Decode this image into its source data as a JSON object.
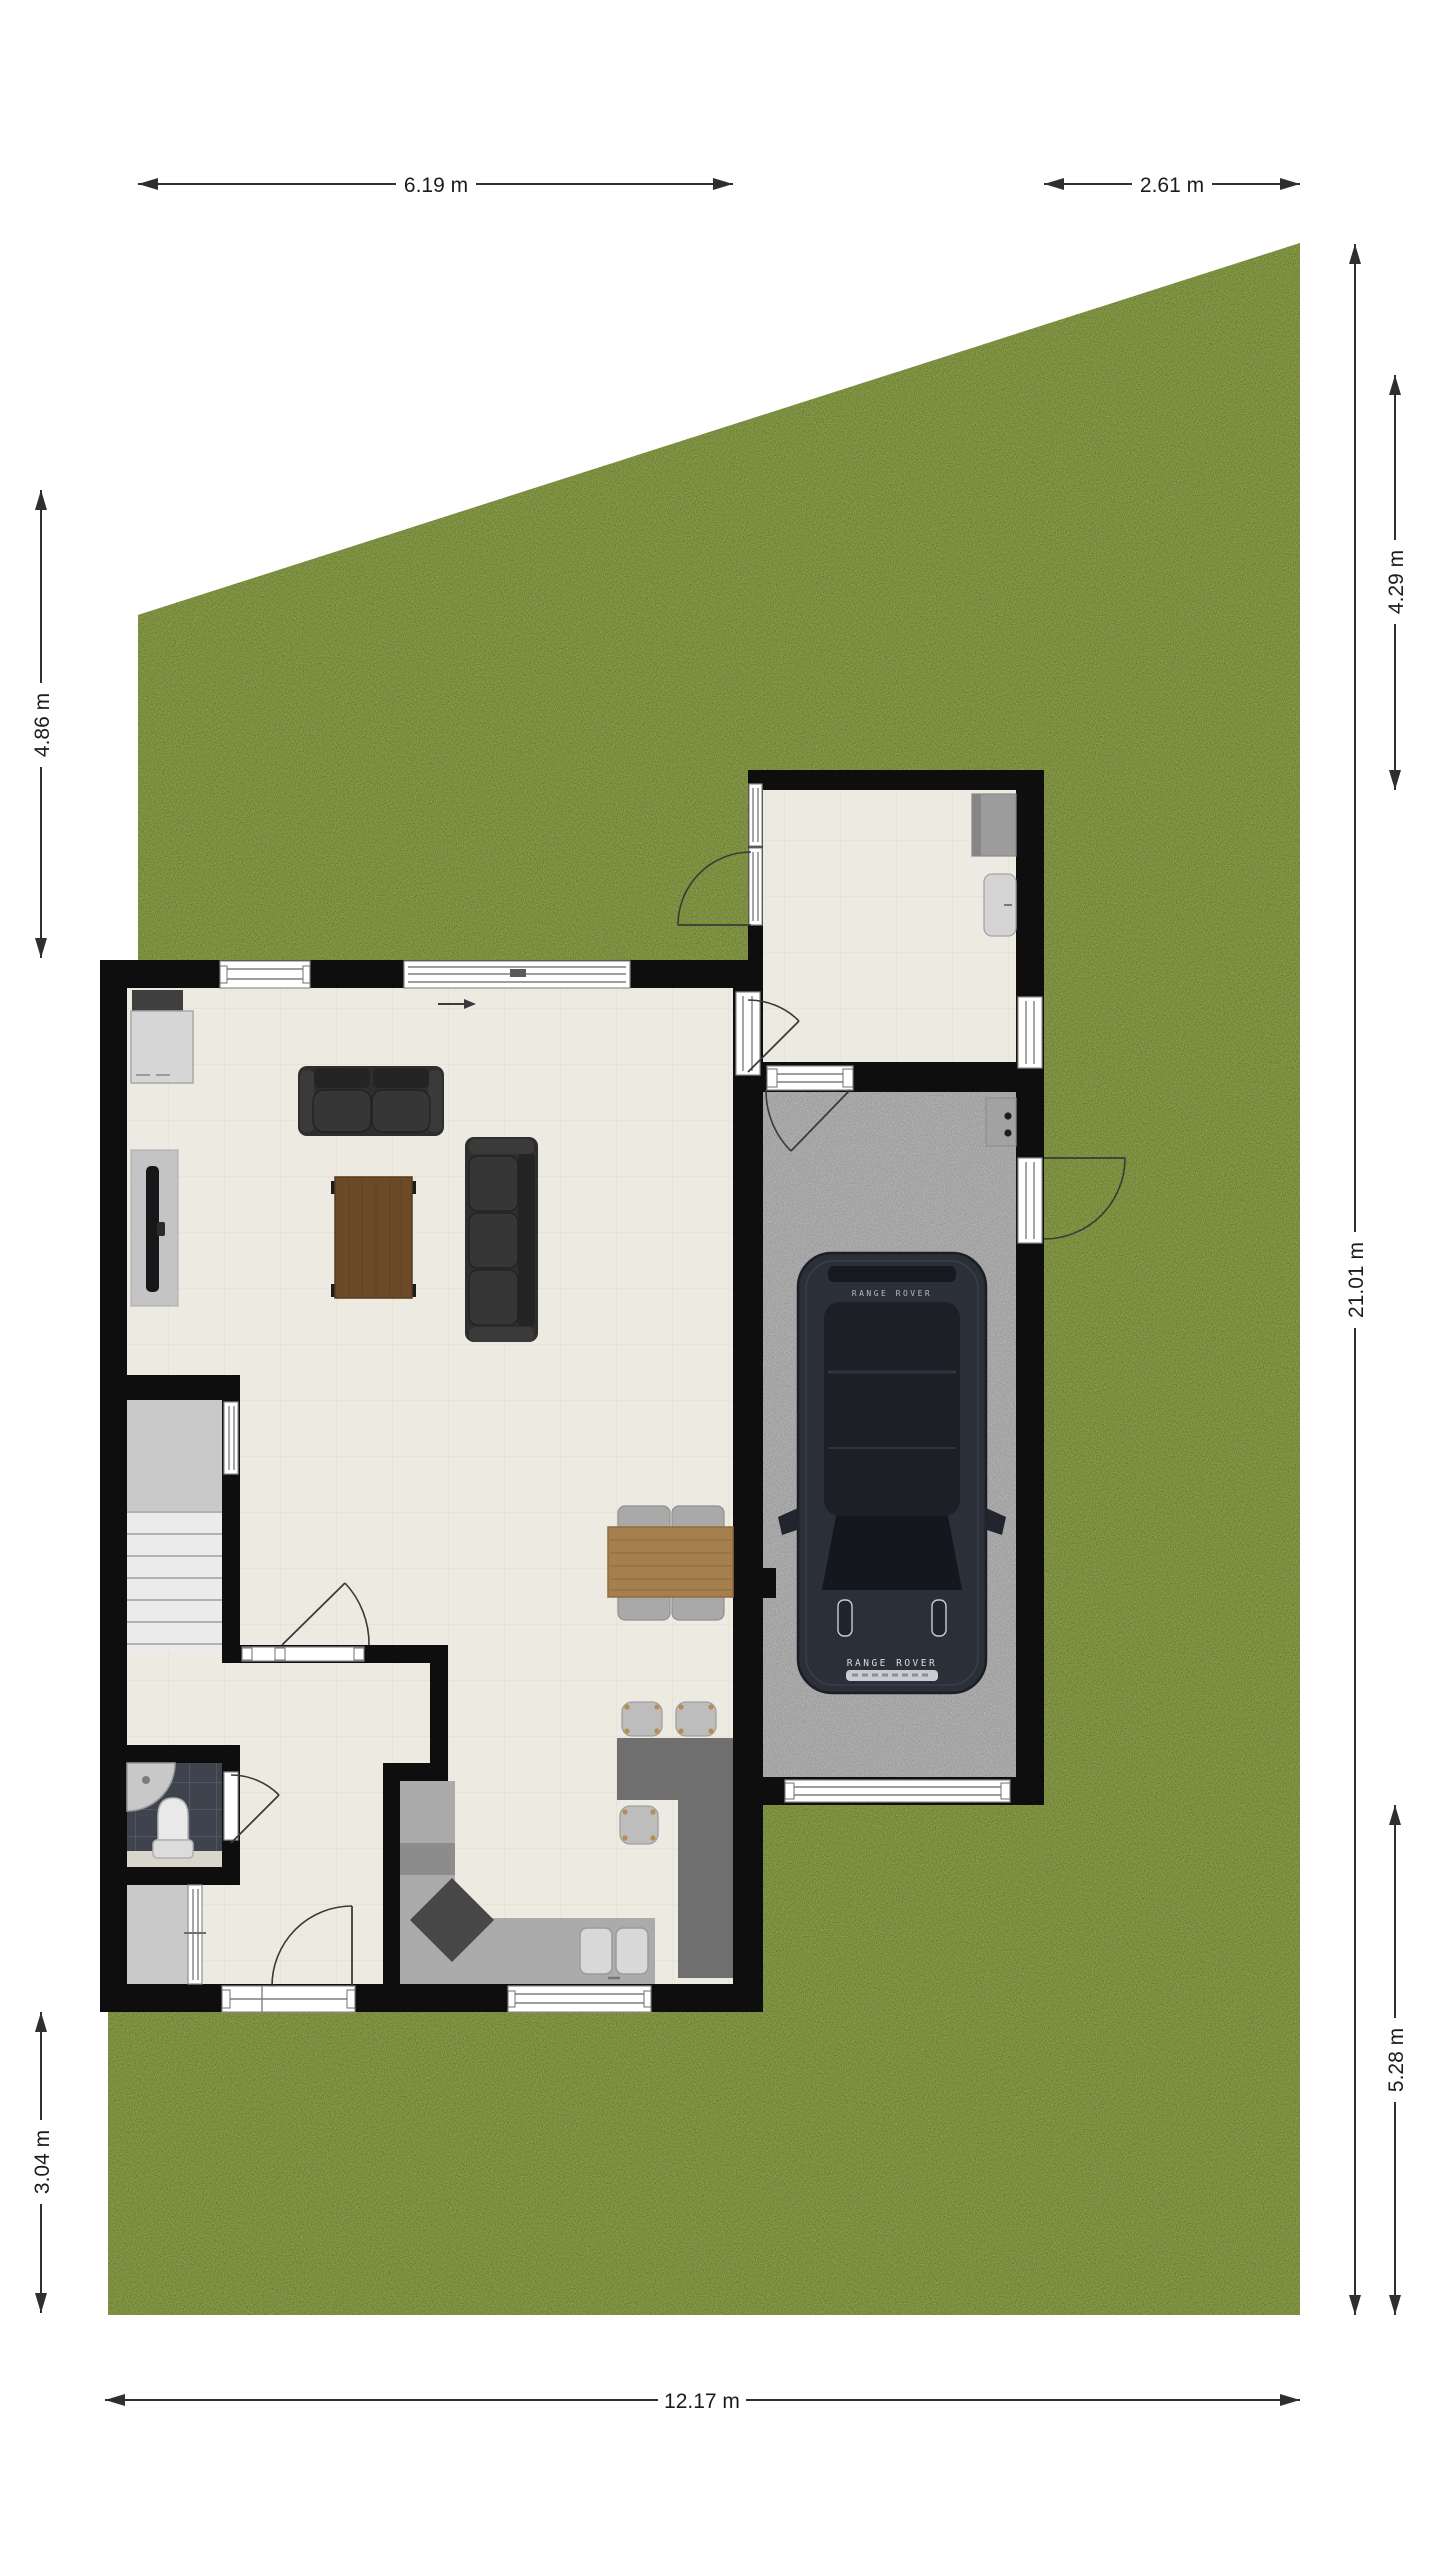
{
  "floorplan": {
    "dimensions": {
      "plot_top_left_width": "6.19 m",
      "plot_top_right_width": "2.61 m",
      "left_upper_height": "4.86 m",
      "left_lower_height": "3.04 m",
      "plot_total_height": "21.01 m",
      "right_upper_height": "4.29 m",
      "right_lower_height": "5.28 m",
      "plot_bottom_width": "12.17 m"
    },
    "car": {
      "brand_text": "RANGE ROVER"
    },
    "colors": {
      "lawn": "#7c9140",
      "wall": "#0e0e0e",
      "floor": "#edebe1",
      "floor_grid": "#ddd9cb",
      "garage_floor": "#b6b6b6",
      "counter_light": "#ababab",
      "counter_dark": "#6f6f6f",
      "wood_table": "#a57f4e",
      "coffee_table": "#6d4a27",
      "sofa": "#2e2e2e",
      "bathroom_tile": "#3e434d",
      "car_body": "#2b2f38",
      "dim_line": "#2f2f2f"
    }
  }
}
